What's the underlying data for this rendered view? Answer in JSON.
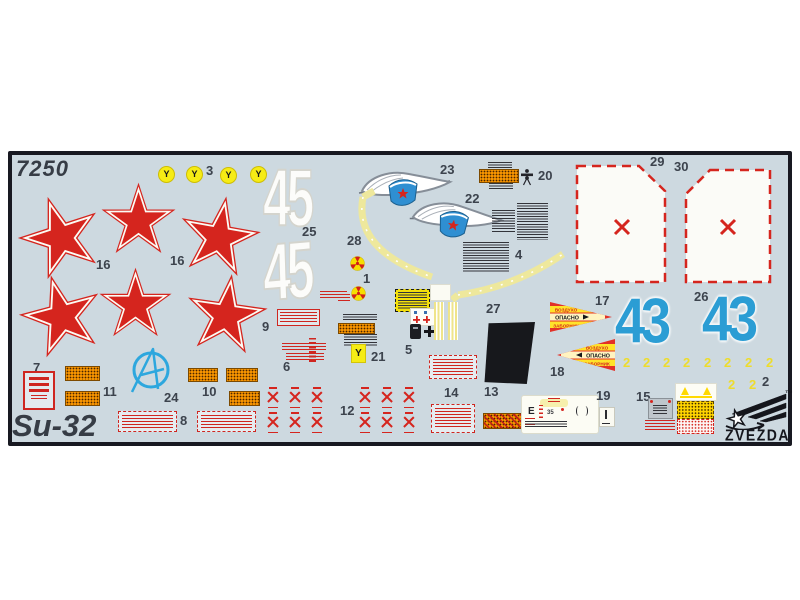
{
  "sheet": {
    "kit_number": "7250",
    "model_name": "Su-32"
  },
  "brand": {
    "name": "ZVEZDA",
    "trademark": "™"
  },
  "part_labels": {
    "1": "1",
    "2": "2",
    "3": "3",
    "4": "4",
    "5": "5",
    "6": "6",
    "7": "7",
    "8": "8",
    "9": "9",
    "10": "10",
    "11": "11",
    "12": "12",
    "13": "13",
    "14": "14",
    "15": "15",
    "16": "16",
    "17": "17",
    "18": "18",
    "19": "19",
    "20": "20",
    "21": "21",
    "22": "22",
    "23": "23",
    "24": "24",
    "25": "25",
    "26": "26",
    "27": "27",
    "28": "28",
    "29": "29",
    "30": "30"
  },
  "markings": {
    "star_number": "16",
    "bort_large_white": "45",
    "bort_large_blue": "43",
    "bort_small_yellow": "2",
    "ejection_glyph": "Y",
    "danger_word_top": "ВОЗДУХО",
    "danger_word_main": "ОПАСНО",
    "danger_word_bottom": "ЗАБОРНИК",
    "panel_letter": "E",
    "panel_code": "35"
  },
  "colors": {
    "sheet_background": "#cdd9e0",
    "star_red": "#d5251e",
    "bort_blue": "#2b9dd4",
    "decal_yellow": "#f6df00"
  }
}
